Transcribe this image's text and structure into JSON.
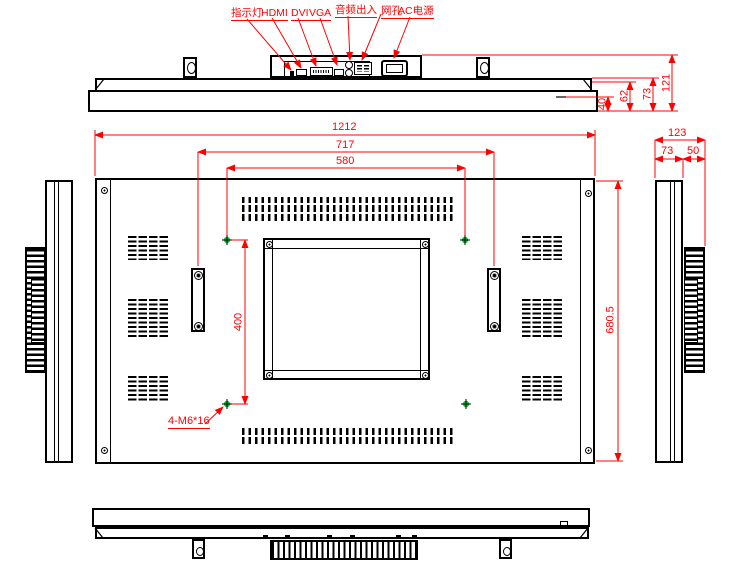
{
  "colors": {
    "dimension_red": "#ff0000",
    "mount_hole_green": "#00c832",
    "line_black": "#000000",
    "background": "#ffffff"
  },
  "top_view": {
    "port_labels": {
      "indicator": "指示灯",
      "hdmi": "HDMI",
      "dvi": "DVI",
      "vga": "VGA",
      "audio": "音频出入",
      "lan": "网孔",
      "ac_power": "AC电源"
    },
    "depth_dims": {
      "d1": "40",
      "d2": "62",
      "d3": "73",
      "d4": "121"
    }
  },
  "rear_view": {
    "width_total": "1212",
    "width_brackets": "717",
    "width_mount_holes": "580",
    "height_mount_holes": "400",
    "height_total": "680.5",
    "mount_hole_note": "4-M6*16"
  },
  "side_view": {
    "depth_total": "123",
    "depth_body": "73",
    "depth_mount": "50"
  }
}
